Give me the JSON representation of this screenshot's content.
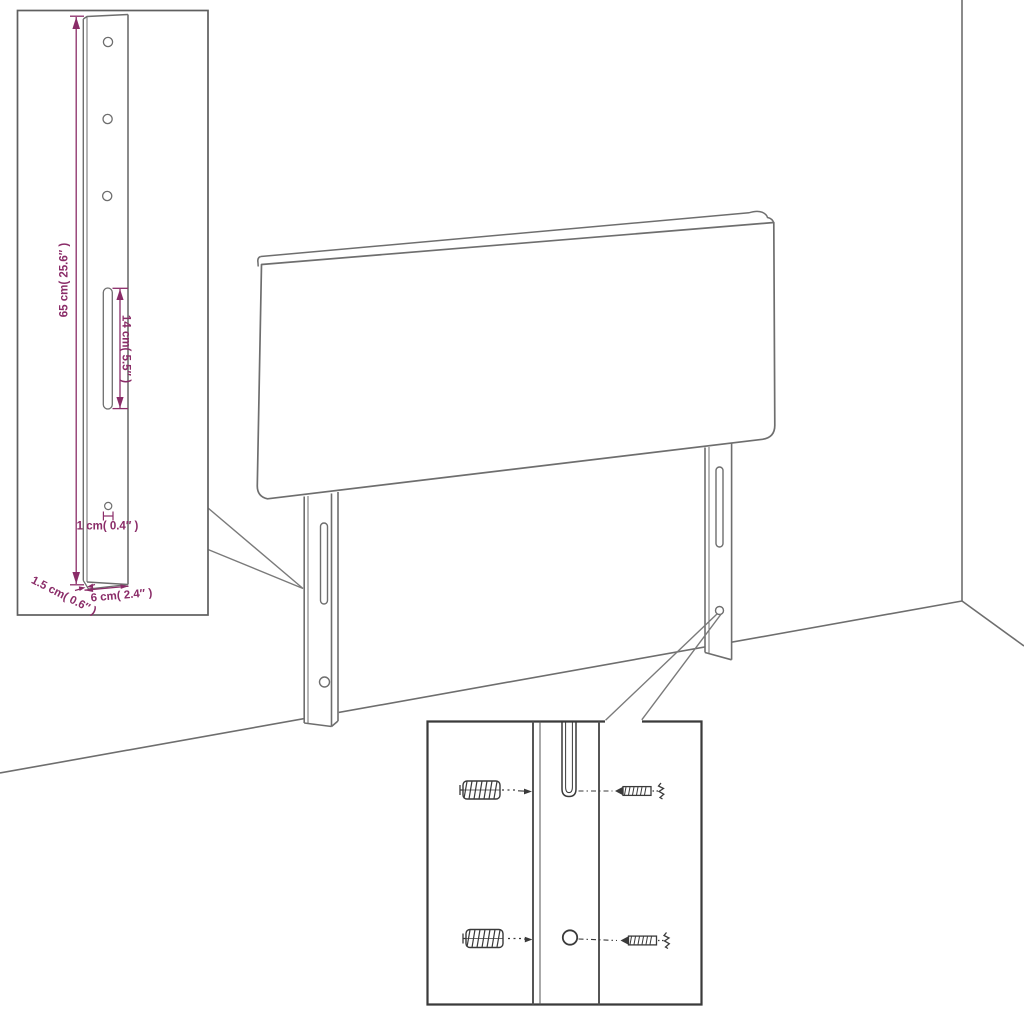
{
  "diagram": {
    "kind": "furniture-assembly-line-drawing",
    "subject": "upholstered headboard with two adjustable mounting legs shown in a room corner",
    "insets": [
      "leg-dimension-detail (top-left)",
      "wall-mounting-hardware-detail (bottom-center)"
    ]
  },
  "colors": {
    "background": "#ffffff",
    "outline_gray": "#6e6e6e",
    "detail_dark_gray": "#3a3a3a",
    "dimension_purple": "#8a2c68"
  },
  "leg_detail": {
    "height_label": "65 cm( 25.6″ )",
    "slot_label": "14 cm( 5.5″ )",
    "hole_label": "1 cm( 0.4″ )",
    "thickness_label": "1.5 cm( 0.6″ )",
    "width_label": "6 cm( 2.4″ )"
  },
  "mounting_detail": {
    "depicted_parts": [
      "wall-anchor",
      "screw",
      "mounting-slot",
      "screw-hole"
    ]
  }
}
